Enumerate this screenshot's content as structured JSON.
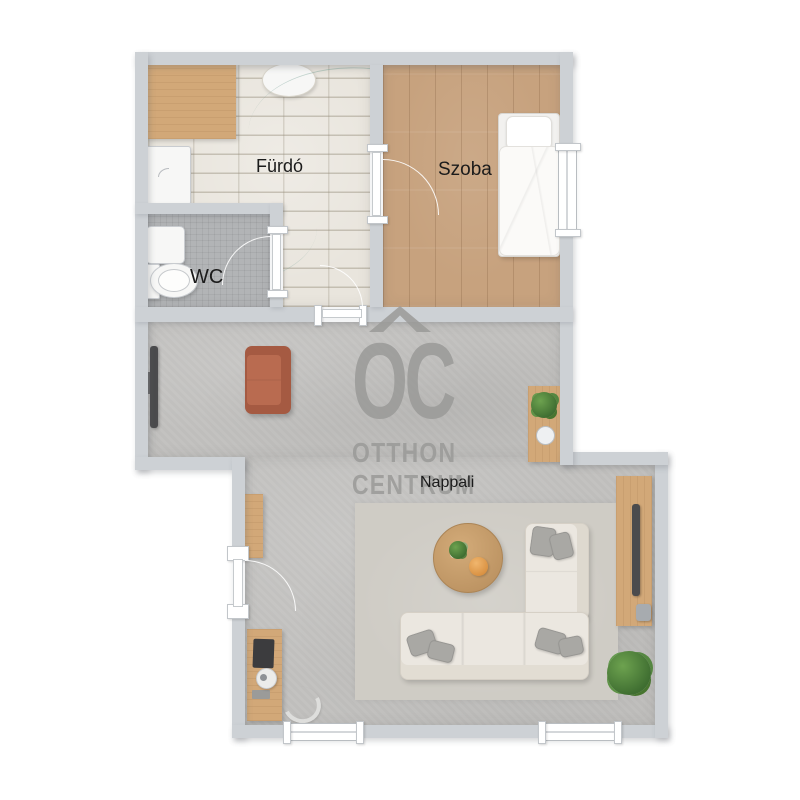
{
  "floorplan": {
    "rooms": {
      "bathroom": {
        "label": "Fürdó"
      },
      "wc": {
        "label": "WC"
      },
      "bedroom": {
        "label": "Szoba"
      },
      "living_room": {
        "label": "Nappali"
      }
    },
    "watermark": {
      "logo_text": "OC",
      "brand_line1": "OTTHON",
      "brand_line2": "CENTRUM"
    },
    "palette": {
      "wall": "#cdd1d5",
      "living_floor": "#c2c1bf",
      "bedroom_floor": "#c7a27e",
      "bathroom_floor": "#e9e5dd",
      "wc_floor": "#b2b4b6",
      "wood_furniture": "#d2a878",
      "sofa_brown": "#ad5f45",
      "sofa_cream": "#ebe7e0",
      "watermark_gray": "#9a9a98",
      "plant_green": "#4e7c3a",
      "label_text": "#1b1b1b"
    }
  }
}
